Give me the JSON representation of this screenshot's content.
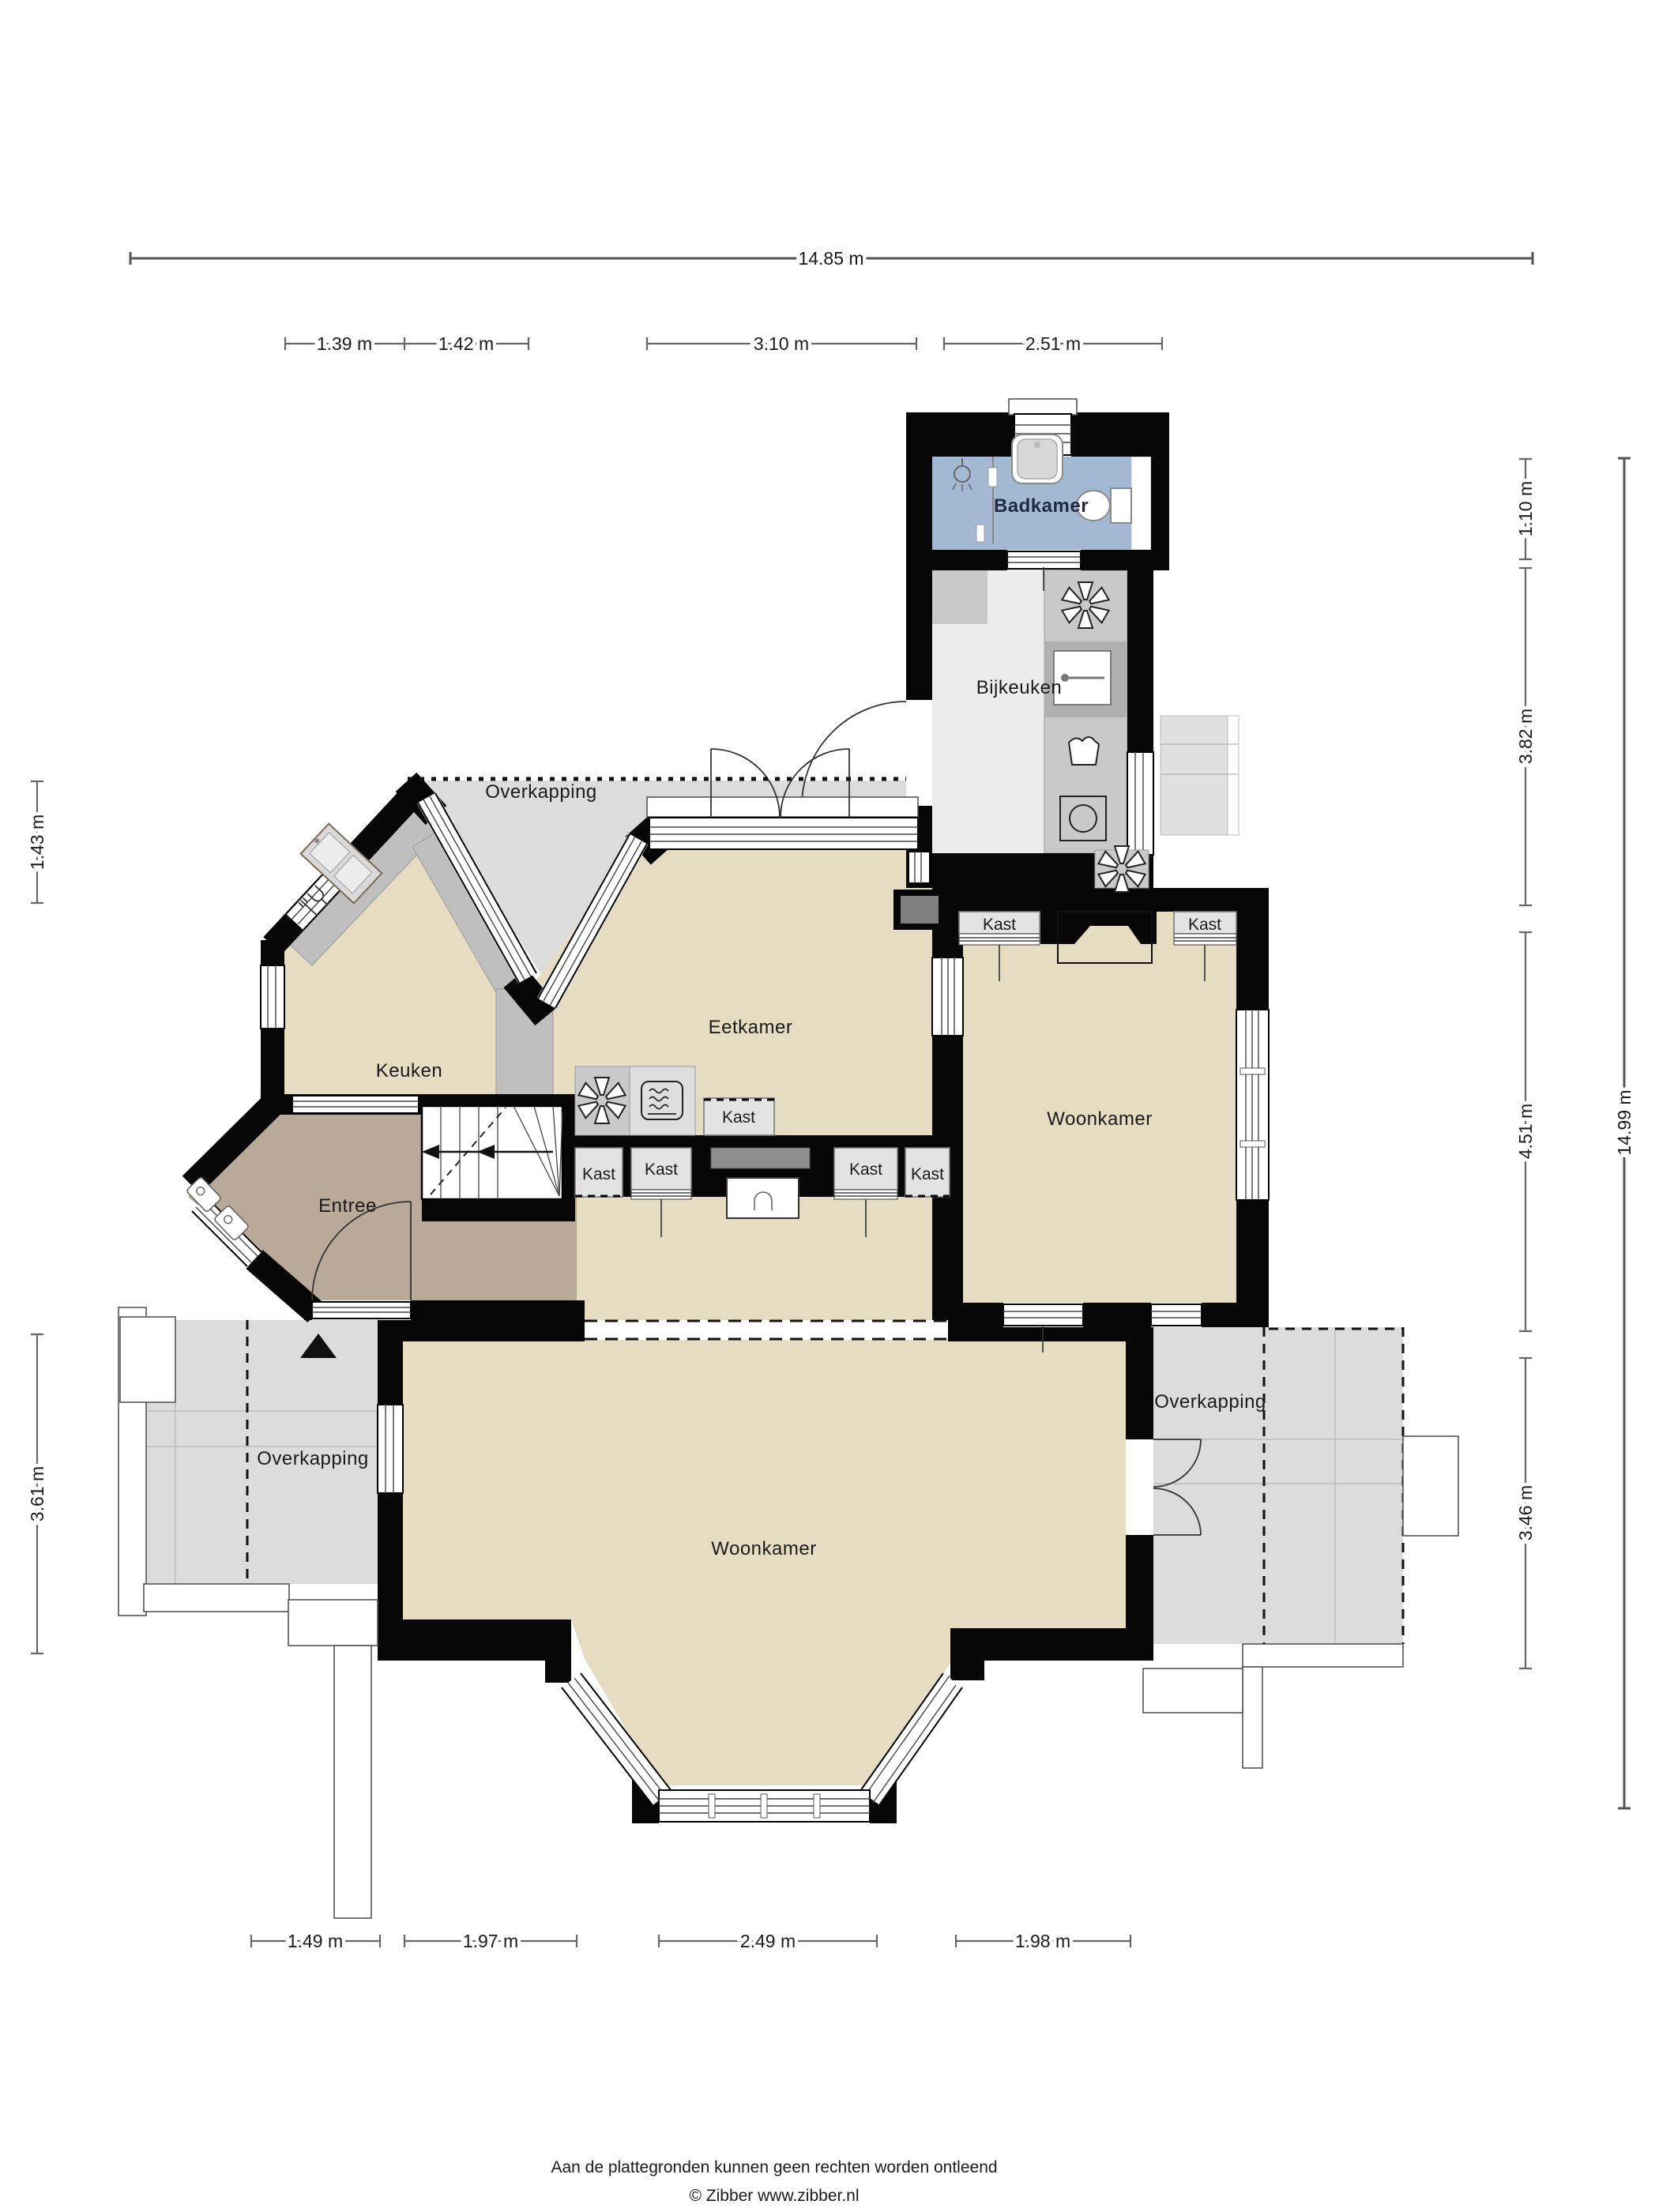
{
  "plan": {
    "rooms": [
      {
        "id": "badkamer",
        "label": "Badkamer"
      },
      {
        "id": "bijkeuken",
        "label": "Bijkeuken"
      },
      {
        "id": "eetkamer",
        "label": "Eetkamer"
      },
      {
        "id": "keuken",
        "label": "Keuken"
      },
      {
        "id": "woonkamer-boven",
        "label": "Woonkamer"
      },
      {
        "id": "entree",
        "label": "Entree"
      },
      {
        "id": "woonkamer-beneden",
        "label": "Woonkamer"
      },
      {
        "id": "overkapping-noord",
        "label": "Overkapping"
      },
      {
        "id": "overkapping-zuidwest",
        "label": "Overkapping"
      },
      {
        "id": "overkapping-zuidoost",
        "label": "Overkapping"
      }
    ],
    "closet_label": "Kast",
    "icons": [
      "extractor-fan-icon",
      "microwave-icon",
      "washing-machine-icon",
      "laundry-icon",
      "sink-icon",
      "kitchen-sink-icon",
      "dishwasher-icon",
      "shower-icon",
      "bathtub-icon",
      "toilet-icon",
      "north-arrow-icon",
      "stairs"
    ]
  },
  "dimensions": {
    "top_total": "14.85 m",
    "top_segments": [
      "1.39 m",
      "1.42 m",
      "3.10 m",
      "2.51 m"
    ],
    "right_segments": [
      "1.10 m",
      "3.82 m",
      "4.51 m",
      "3.46 m"
    ],
    "right_total": "14.99 m",
    "left_segments": [
      "1.43 m",
      "3.61 m"
    ],
    "bottom_segments": [
      "1.49 m",
      "1.97 m",
      "2.49 m",
      "1.98 m"
    ]
  },
  "footer": {
    "disclaimer": "Aan de plattegronden kunnen geen rechten worden ontleend",
    "copyright": "© Zibber www.zibber.nl"
  },
  "colors": {
    "wall": "#070707",
    "floor_living": "#e6dcc2",
    "floor_entree": "#b8a998",
    "floor_bath": "#a3b8d3",
    "floor_utility": "#ececec",
    "overkapping": "#dcdcdc",
    "counter": "#c2c2c2"
  }
}
